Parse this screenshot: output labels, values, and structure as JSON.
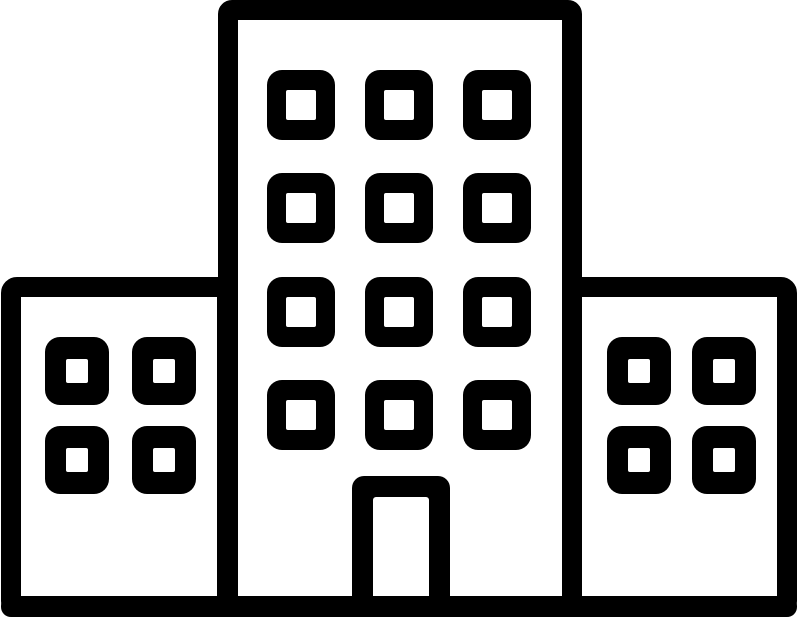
{
  "icon": {
    "name": "apartment-building-icon",
    "description": "Black outline pictogram of a building complex: a tall central tower with a 3x4 grid of square windows and a centered entrance door, flanked by two shorter side wings each with a 2x2 grid of square windows, all standing on a single ground baseline",
    "stroke_color": "#000000",
    "fill_color": "#ffffff",
    "canvas": {
      "width": 800,
      "height": 618
    },
    "buildings": [
      {
        "part": "left-wing",
        "outer": [
          1,
          277,
          236,
          340
        ],
        "stroke": 20,
        "corner_radius": 16
      },
      {
        "part": "right-wing",
        "outer": [
          562,
          277,
          235,
          340
        ],
        "stroke": 20,
        "corner_radius": 16
      },
      {
        "part": "center-tower",
        "outer": [
          218,
          0,
          364,
          617
        ],
        "stroke": 20,
        "corner_radius": 14
      }
    ],
    "window_grids": [
      {
        "part": "center-tower-window",
        "cols_x": [
          267,
          365,
          463
        ],
        "rows_y": [
          70,
          173,
          277,
          380
        ],
        "outer_w": 68,
        "outer_h": 70,
        "inner_w": 30,
        "inner_h": 30,
        "outer_radius": 15,
        "inner_radius": 2,
        "count": 12
      },
      {
        "part": "left-wing-window",
        "cols_x": [
          45,
          132
        ],
        "rows_y": [
          337,
          426
        ],
        "outer_w": 64,
        "outer_h": 68,
        "inner_w": 22,
        "inner_h": 24,
        "outer_radius": 15,
        "inner_radius": 2,
        "count": 4
      },
      {
        "part": "right-wing-window",
        "cols_x": [
          607,
          692
        ],
        "rows_y": [
          337,
          426
        ],
        "outer_w": 64,
        "outer_h": 68,
        "inner_w": 22,
        "inner_h": 24,
        "outer_radius": 15,
        "inner_radius": 2,
        "count": 4
      }
    ],
    "door": {
      "outer": [
        352,
        476,
        98,
        141
      ],
      "inner": [
        373,
        497,
        56,
        120
      ],
      "outer_radius": 12,
      "inner_radius": 3
    },
    "baseline": {
      "rect": [
        1,
        596,
        796,
        21
      ],
      "radius": 10
    }
  }
}
